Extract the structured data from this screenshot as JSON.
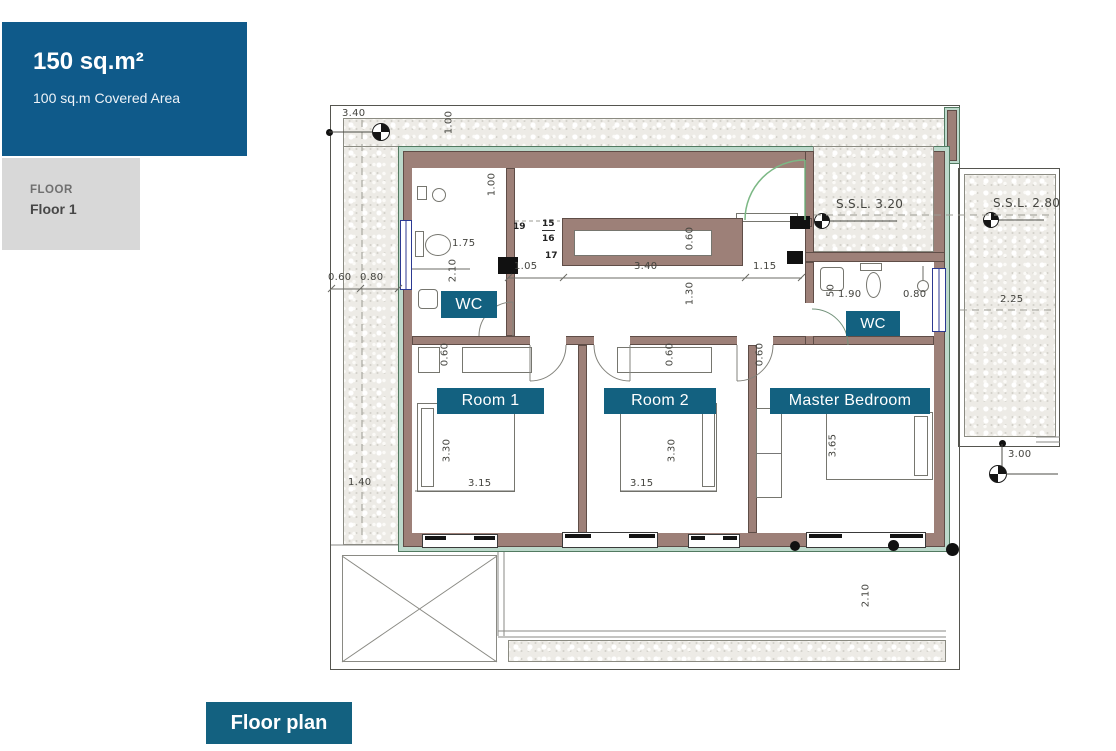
{
  "panel": {
    "area": "150 sq.m²",
    "covered": "100 sq.m Covered Area",
    "floor_heading": "FLOOR",
    "floor_value": "Floor 1"
  },
  "caption": "Floor plan",
  "labels": {
    "wc1": "WC",
    "wc2": "WC",
    "room1": "Room 1",
    "room2": "Room 2",
    "master": "Master Bedroom"
  },
  "levels": {
    "entry_terrace": "S.S.L. 3.20",
    "side_terrace": "S.S.L. 2.80"
  },
  "stair_steps": {
    "s19": "19",
    "s15": "15",
    "s16": "16",
    "s17": "17"
  },
  "dims": {
    "site_top": "3.40",
    "band_depth": "1.00",
    "shower": "1.00",
    "toilet": "1.75",
    "bath_length": "2.10",
    "strip_a": "0.60",
    "strip_b": "0.80",
    "strip_c": "1.40",
    "hall_left": "1.05",
    "hall_mid": "3.40",
    "hall_right": "1.15",
    "counter_depth": "0.60",
    "hall_width": "1.30",
    "closet_room1": "0.60",
    "closet_room2": "0.60",
    "closet_master": "0.60",
    "bed1_length": "3.30",
    "room1_width": "3.15",
    "bed2_length": "3.30",
    "room2_width": "3.15",
    "master_bed_length": "3.65",
    "wc2_a": "50",
    "wc2_b": "1.90",
    "wc2_c": "0.80",
    "terrace_width": "2.25",
    "terrace_bottom": "3.00",
    "veranda_depth": "2.10"
  },
  "colors": {
    "panel_bg": "#0f5a8a",
    "panel_text": "#ffffff",
    "floor_card_bg": "#d8d8d8",
    "chip_bg": "#136180",
    "wall": "#9d8078",
    "insulation_band": "#bcd9cb",
    "door_arc": "#7cb885",
    "window_frame": "#2c3a92",
    "dim_text": "#44443f"
  }
}
